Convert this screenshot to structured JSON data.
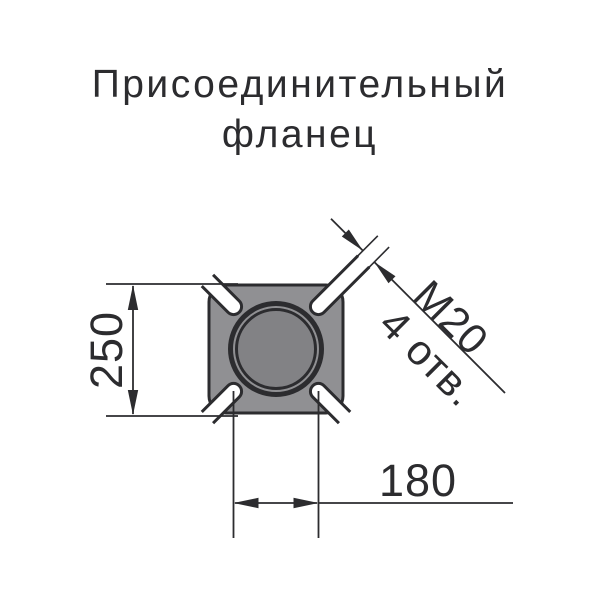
{
  "title": {
    "line1": "Присоединительный",
    "line2": "фланец"
  },
  "dimensions": {
    "flange_height": "250",
    "bolt_spacing": "180",
    "thread": "M20",
    "holes": "4 отв."
  },
  "colors": {
    "line": "#2c2c2f",
    "flange_fill": "#909093",
    "bore_fill": "#828285",
    "background": "#ffffff"
  }
}
